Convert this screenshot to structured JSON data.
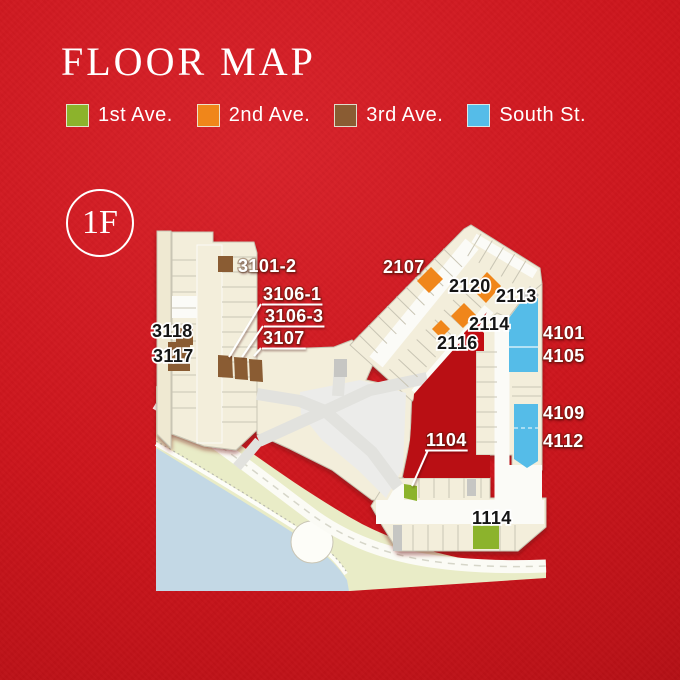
{
  "title": "FLOOR MAP",
  "floor_badge": "1F",
  "legend": {
    "items": [
      {
        "label": "1st Ave.",
        "color": "#8cb32c"
      },
      {
        "label": "2nd Ave.",
        "color": "#f0861a"
      },
      {
        "label": "3rd Ave.",
        "color": "#8a5c33"
      },
      {
        "label": "South St.",
        "color": "#55bce8"
      }
    ]
  },
  "map": {
    "colors": {
      "background_red": "#cd161d",
      "first_ave": "#8cb32c",
      "second_ave": "#f0861a",
      "third_ave": "#8a5c33",
      "south_st": "#55bce8",
      "accent_unit_red": "#c30d12",
      "building_cream": "#f3eedb",
      "water_blue": "#c3d8e5",
      "land_olive": "#e9ecc7"
    },
    "units": [
      {
        "id": "3101-2",
        "street": "3rd Ave."
      },
      {
        "id": "3106-1",
        "street": "3rd Ave."
      },
      {
        "id": "3106-3",
        "street": "3rd Ave."
      },
      {
        "id": "3107",
        "street": "3rd Ave."
      },
      {
        "id": "3117",
        "street": "3rd Ave."
      },
      {
        "id": "3118",
        "street": "3rd Ave."
      },
      {
        "id": "2107",
        "street": "2nd Ave."
      },
      {
        "id": "2113",
        "street": "2nd Ave."
      },
      {
        "id": "2114",
        "street": "2nd Ave."
      },
      {
        "id": "2116",
        "street": "2nd Ave."
      },
      {
        "id": "2120",
        "street": "2nd Ave."
      },
      {
        "id": "4101",
        "street": "South St."
      },
      {
        "id": "4105",
        "street": "South St."
      },
      {
        "id": "4109",
        "street": "South St."
      },
      {
        "id": "4112",
        "street": "South St."
      },
      {
        "id": "1104",
        "street": "1st Ave."
      },
      {
        "id": "1114",
        "street": "1st Ave."
      }
    ],
    "labels": [
      {
        "text": "3101-2",
        "x": 238,
        "y": 272,
        "color": "white"
      },
      {
        "text": "3106-1",
        "x": 263,
        "y": 300,
        "color": "white",
        "underline": true,
        "leader": [
          261,
          304,
          229,
          357
        ]
      },
      {
        "text": "3106-3",
        "x": 265,
        "y": 322,
        "color": "white",
        "underline": true,
        "leader": [
          263,
          326,
          242,
          357
        ]
      },
      {
        "text": "3107",
        "x": 263,
        "y": 344,
        "color": "white",
        "underline": true,
        "leader": [
          261,
          348,
          254,
          356
        ]
      },
      {
        "text": "3118",
        "x": 152,
        "y": 337,
        "color": "black"
      },
      {
        "text": "3117",
        "x": 153,
        "y": 362,
        "color": "black"
      },
      {
        "text": "2107",
        "x": 383,
        "y": 273,
        "color": "white"
      },
      {
        "text": "2120",
        "x": 449,
        "y": 292,
        "color": "black"
      },
      {
        "text": "2113",
        "x": 496,
        "y": 302,
        "color": "black"
      },
      {
        "text": "2114",
        "x": 469,
        "y": 330,
        "color": "black"
      },
      {
        "text": "2116",
        "x": 437,
        "y": 349,
        "color": "black"
      },
      {
        "text": "4101",
        "x": 543,
        "y": 339,
        "color": "white"
      },
      {
        "text": "4105",
        "x": 543,
        "y": 362,
        "color": "white"
      },
      {
        "text": "4109",
        "x": 543,
        "y": 419,
        "color": "white"
      },
      {
        "text": "4112",
        "x": 543,
        "y": 447,
        "color": "white"
      },
      {
        "text": "1104",
        "x": 426,
        "y": 446,
        "color": "white",
        "underline": true,
        "leader": [
          428,
          450,
          412,
          486
        ]
      },
      {
        "text": "1114",
        "x": 472,
        "y": 524,
        "color": "black"
      }
    ]
  }
}
